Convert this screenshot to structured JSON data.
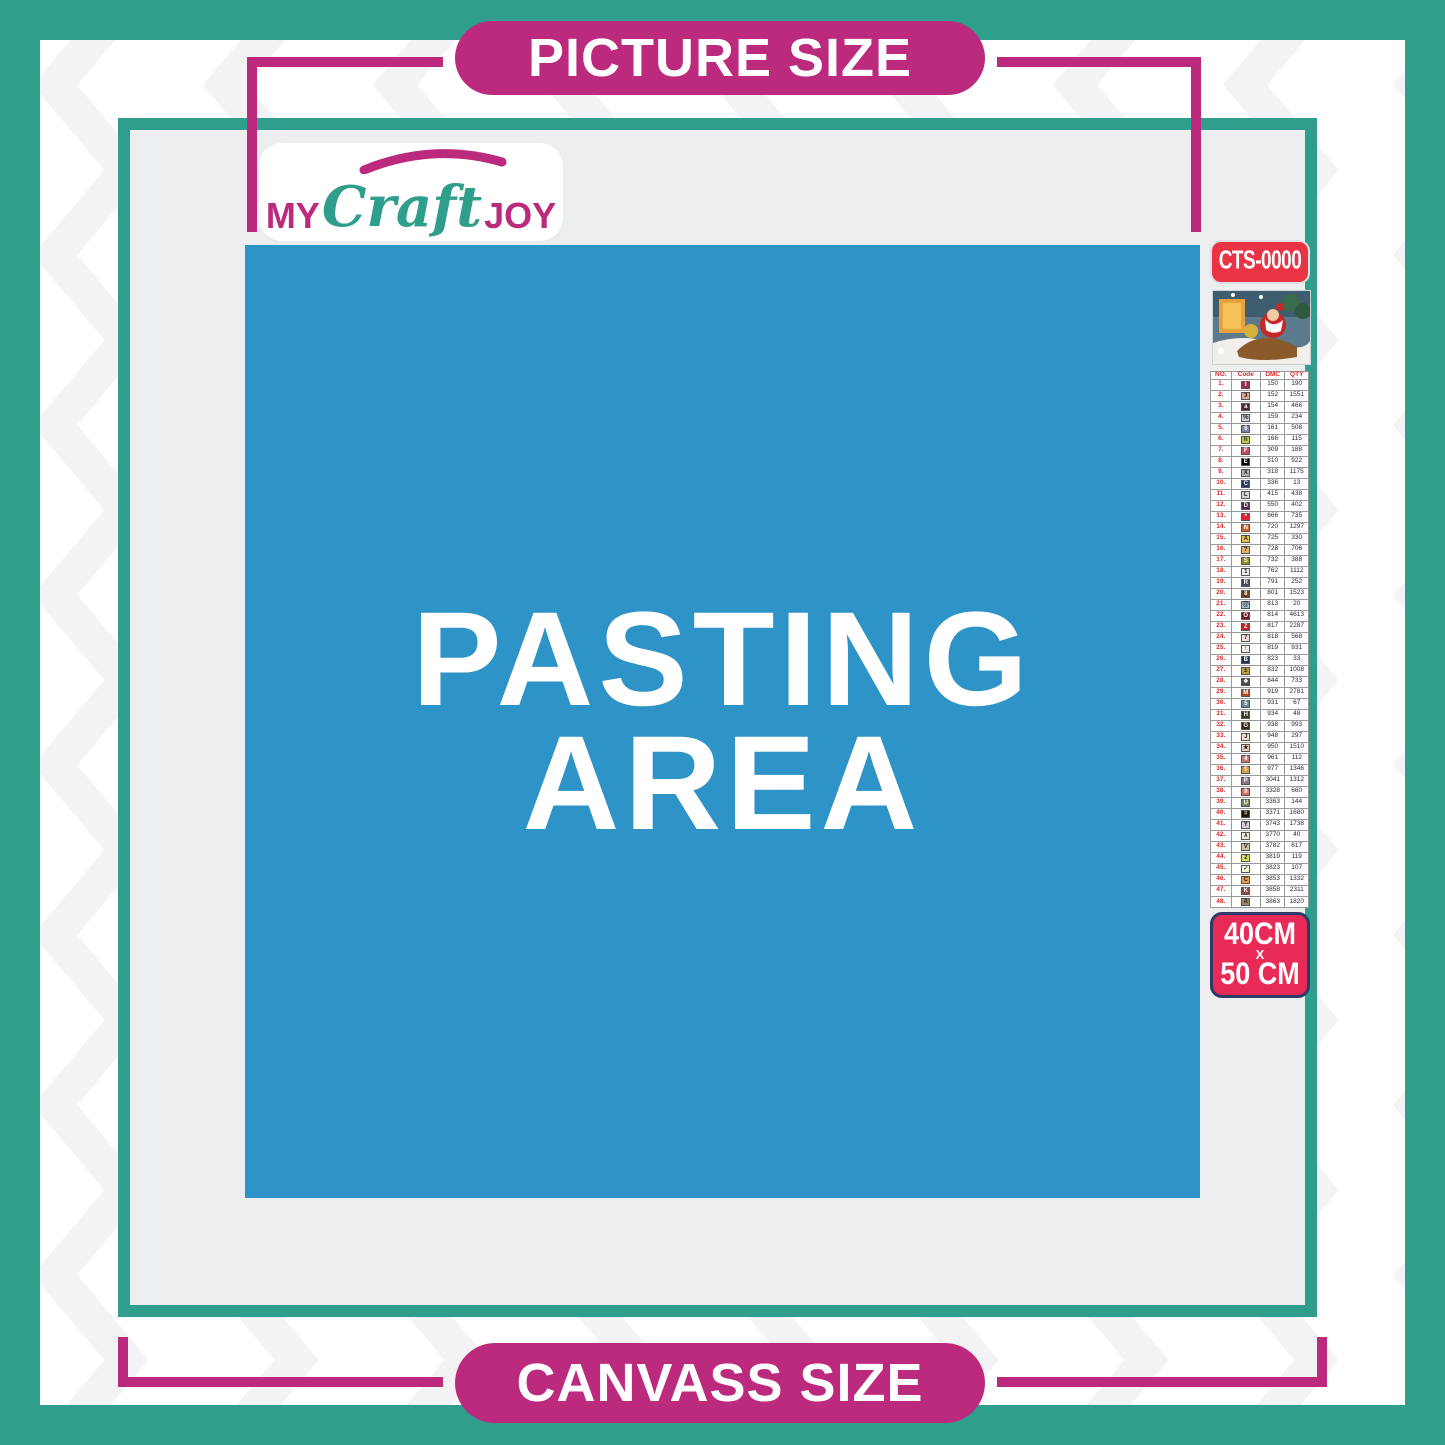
{
  "banners": {
    "top": "PICTURE SIZE",
    "bottom": "CANVASS SIZE"
  },
  "pasting_area": {
    "line1": "PASTING",
    "line2": "AREA"
  },
  "logo": {
    "my": "MY",
    "craft": "Craft",
    "joy": "JOY"
  },
  "sidebar": {
    "sku": "CTS-0000",
    "size": {
      "line1": "40CM",
      "line2": "X",
      "line3": "50 CM"
    }
  },
  "legend": {
    "columns": [
      "NO.",
      "Code",
      "DMC",
      "QTY"
    ],
    "rows": [
      {
        "no": "1.",
        "sym": "t",
        "bg": "#9E2C52",
        "fg": "#FFFFFF",
        "dmc": "150",
        "qty": "190"
      },
      {
        "no": "2.",
        "sym": "3",
        "bg": "#E3A499",
        "fg": "#222222",
        "dmc": "152",
        "qty": "1551"
      },
      {
        "no": "3.",
        "sym": "a",
        "bg": "#53253B",
        "fg": "#FFFFFF",
        "dmc": "154",
        "qty": "466"
      },
      {
        "no": "4.",
        "sym": "%",
        "bg": "#C8CCD8",
        "fg": "#222222",
        "dmc": "159",
        "qty": "234"
      },
      {
        "no": "5.",
        "sym": "6",
        "bg": "#7A81A6",
        "fg": "#FFFFFF",
        "dmc": "161",
        "qty": "508"
      },
      {
        "no": "6.",
        "sym": "h",
        "bg": "#C3CA42",
        "fg": "#222222",
        "dmc": "166",
        "qty": "115"
      },
      {
        "no": "7.",
        "sym": "F",
        "bg": "#C34B5A",
        "fg": "#FFFFFF",
        "dmc": "309",
        "qty": "188"
      },
      {
        "no": "8.",
        "sym": "E",
        "bg": "#000000",
        "fg": "#FFFFFF",
        "dmc": "310",
        "qty": "922"
      },
      {
        "no": "9.",
        "sym": "X",
        "bg": "#AFAFAF",
        "fg": "#222222",
        "dmc": "318",
        "qty": "1175"
      },
      {
        "no": "10.",
        "sym": "C",
        "bg": "#28386B",
        "fg": "#FFFFFF",
        "dmc": "336",
        "qty": "13"
      },
      {
        "no": "11.",
        "sym": "L",
        "bg": "#D4D4D8",
        "fg": "#222222",
        "dmc": "415",
        "qty": "438"
      },
      {
        "no": "12.",
        "sym": "D",
        "bg": "#5B2250",
        "fg": "#FFFFFF",
        "dmc": "550",
        "qty": "402"
      },
      {
        "no": "13.",
        "sym": "*",
        "bg": "#DE2537",
        "fg": "#FFFFFF",
        "dmc": "666",
        "qty": "735"
      },
      {
        "no": "14.",
        "sym": "N",
        "bg": "#E25B20",
        "fg": "#FFFFFF",
        "dmc": "720",
        "qty": "1297"
      },
      {
        "no": "15.",
        "sym": "A",
        "bg": "#EFC145",
        "fg": "#222222",
        "dmc": "725",
        "qty": "330"
      },
      {
        "no": "16.",
        "sym": "?",
        "bg": "#E2B163",
        "fg": "#222222",
        "dmc": "728",
        "qty": "706"
      },
      {
        "no": "17.",
        "sym": "S",
        "bg": "#928B1E",
        "fg": "#FFFFFF",
        "dmc": "732",
        "qty": "388"
      },
      {
        "no": "18.",
        "sym": "1",
        "bg": "#EDEDED",
        "fg": "#222222",
        "dmc": "762",
        "qty": "1112"
      },
      {
        "no": "19.",
        "sym": "R",
        "bg": "#474666",
        "fg": "#FFFFFF",
        "dmc": "791",
        "qty": "252"
      },
      {
        "no": "20.",
        "sym": "8",
        "bg": "#6A3A1B",
        "fg": "#FFFFFF",
        "dmc": "801",
        "qty": "1523"
      },
      {
        "no": "21.",
        "sym": "@",
        "bg": "#A6C4DA",
        "fg": "#222222",
        "dmc": "813",
        "qty": "20"
      },
      {
        "no": "22.",
        "sym": "O",
        "bg": "#751927",
        "fg": "#FFFFFF",
        "dmc": "814",
        "qty": "4613"
      },
      {
        "no": "23.",
        "sym": "Z",
        "bg": "#C22222",
        "fg": "#FFFFFF",
        "dmc": "817",
        "qty": "2287"
      },
      {
        "no": "24.",
        "sym": "7",
        "bg": "#F8DCD6",
        "fg": "#222222",
        "dmc": "818",
        "qty": "568"
      },
      {
        "no": "25.",
        "sym": "↑",
        "bg": "#FAEDE8",
        "fg": "#222222",
        "dmc": "819",
        "qty": "931"
      },
      {
        "no": "26.",
        "sym": "B",
        "bg": "#203059",
        "fg": "#FFFFFF",
        "dmc": "823",
        "qty": "33"
      },
      {
        "no": "27.",
        "sym": "±",
        "bg": "#BC9C3D",
        "fg": "#222222",
        "dmc": "832",
        "qty": "1008"
      },
      {
        "no": "28.",
        "sym": "❖",
        "bg": "#4A4A4A",
        "fg": "#FFFFFF",
        "dmc": "844",
        "qty": "733"
      },
      {
        "no": "29.",
        "sym": "M",
        "bg": "#A84E2B",
        "fg": "#FFFFFF",
        "dmc": "919",
        "qty": "2781"
      },
      {
        "no": "30.",
        "sym": "5",
        "bg": "#6B86A0",
        "fg": "#FFFFFF",
        "dmc": "931",
        "qty": "67"
      },
      {
        "no": "31.",
        "sym": "H",
        "bg": "#343B20",
        "fg": "#FFFFFF",
        "dmc": "934",
        "qty": "48"
      },
      {
        "no": "32.",
        "sym": "G",
        "bg": "#3A2513",
        "fg": "#FFFFFF",
        "dmc": "938",
        "qty": "993"
      },
      {
        "no": "33.",
        "sym": "J",
        "bg": "#F9DECB",
        "fg": "#222222",
        "dmc": "948",
        "qty": "297"
      },
      {
        "no": "34.",
        "sym": "★",
        "bg": "#ECCDB5",
        "fg": "#222222",
        "dmc": "950",
        "qty": "1510"
      },
      {
        "no": "35.",
        "sym": "4",
        "bg": "#C97876",
        "fg": "#FFFFFF",
        "dmc": "961",
        "qty": "112"
      },
      {
        "no": "36.",
        "sym": "T",
        "bg": "#D99A51",
        "fg": "#FFFFFF",
        "dmc": "977",
        "qty": "1346"
      },
      {
        "no": "37.",
        "sym": "P",
        "bg": "#8E7085",
        "fg": "#FFFFFF",
        "dmc": "3041",
        "qty": "1312"
      },
      {
        "no": "38.",
        "sym": "9",
        "bg": "#DD6E64",
        "fg": "#FFFFFF",
        "dmc": "3328",
        "qty": "660"
      },
      {
        "no": "39.",
        "sym": "U",
        "bg": "#79885F",
        "fg": "#FFFFFF",
        "dmc": "3363",
        "qty": "144"
      },
      {
        "no": "40.",
        "sym": "=",
        "bg": "#201308",
        "fg": "#FFFFFF",
        "dmc": "3371",
        "qty": "1680"
      },
      {
        "no": "41.",
        "sym": "Y",
        "bg": "#D6CBD8",
        "fg": "#222222",
        "dmc": "3743",
        "qty": "1738"
      },
      {
        "no": "42.",
        "sym": "∧",
        "bg": "#FBEEE1",
        "fg": "#222222",
        "dmc": "3770",
        "qty": "40"
      },
      {
        "no": "43.",
        "sym": "V",
        "bg": "#D5BFA7",
        "fg": "#222222",
        "dmc": "3782",
        "qty": "617"
      },
      {
        "no": "44.",
        "sym": "2",
        "bg": "#DFE45F",
        "fg": "#222222",
        "dmc": "3819",
        "qty": "119"
      },
      {
        "no": "45.",
        "sym": "✓",
        "bg": "#FCF8DA",
        "fg": "#222222",
        "dmc": "3823",
        "qty": "107"
      },
      {
        "no": "46.",
        "sym": "C",
        "bg": "#EE9A4C",
        "fg": "#222222",
        "dmc": "3853",
        "qty": "1332"
      },
      {
        "no": "47.",
        "sym": "K",
        "bg": "#8F4A44",
        "fg": "#FFFFFF",
        "dmc": "3858",
        "qty": "2311"
      },
      {
        "no": "48.",
        "sym": "A",
        "bg": "#A58568",
        "fg": "#222222",
        "dmc": "3863",
        "qty": "1820"
      }
    ]
  },
  "colors": {
    "teal": "#2F9E8C",
    "magenta": "#BC2A7E",
    "blue": "#2E93C6",
    "gray": "#EDEEEF",
    "chevron": "#F3F3F5",
    "sku-red": "#EA3445",
    "size-red": "#E82A56",
    "size-border": "#2E3A67"
  }
}
